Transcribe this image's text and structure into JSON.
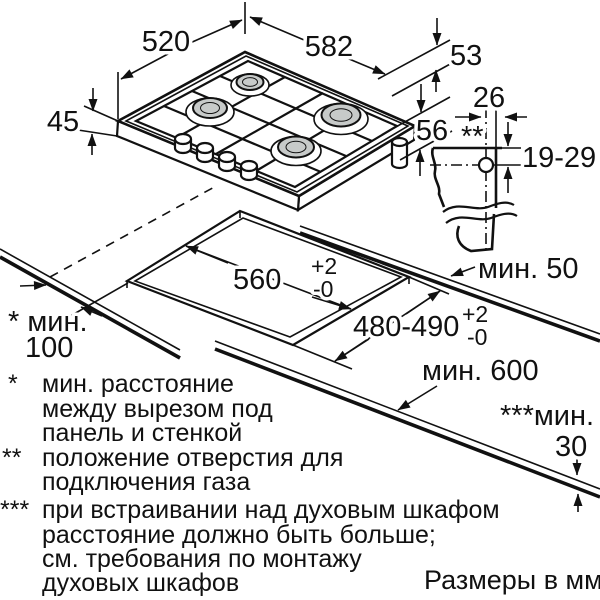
{
  "title": "Схема встраивания газовой варочной панели",
  "colors": {
    "ink": "#111111",
    "burner_fill": "#c7cac9",
    "background": "#ffffff"
  },
  "units_caption": "Размеры в мм",
  "hob": {
    "depth_label": "520",
    "width_label": "582",
    "edge_label": "53",
    "height_label": "45",
    "body_height_label": "56",
    "burner_count": 4
  },
  "gas_connection": {
    "offset_label": "26",
    "marker": "**",
    "depth_label": "19-29"
  },
  "worktop": {
    "cutout_width": {
      "value": "560",
      "sup": "+2",
      "sub": "-0"
    },
    "cutout_depth": {
      "value": "480-490",
      "sup": "+2",
      "sub": "-0"
    },
    "min_front": "мин. 50",
    "depth_min": "мин. 600",
    "min_wall": {
      "line1": "* мин.",
      "line2": "100"
    },
    "min_oven": {
      "line1": "***мин.",
      "line2": "30"
    }
  },
  "footnotes": [
    {
      "marker": "*",
      "lines": [
        "мин. расстояние",
        "между вырезом под",
        "панель и стенкой"
      ]
    },
    {
      "marker": "**",
      "lines": [
        "положение отверстия для",
        "подключения газа"
      ]
    },
    {
      "marker": "***",
      "lines": [
        "при встраивании над духовым шкафом",
        "расстояние должно быть больше;",
        "см. требования по монтажу",
        "духовых шкафов"
      ]
    }
  ]
}
